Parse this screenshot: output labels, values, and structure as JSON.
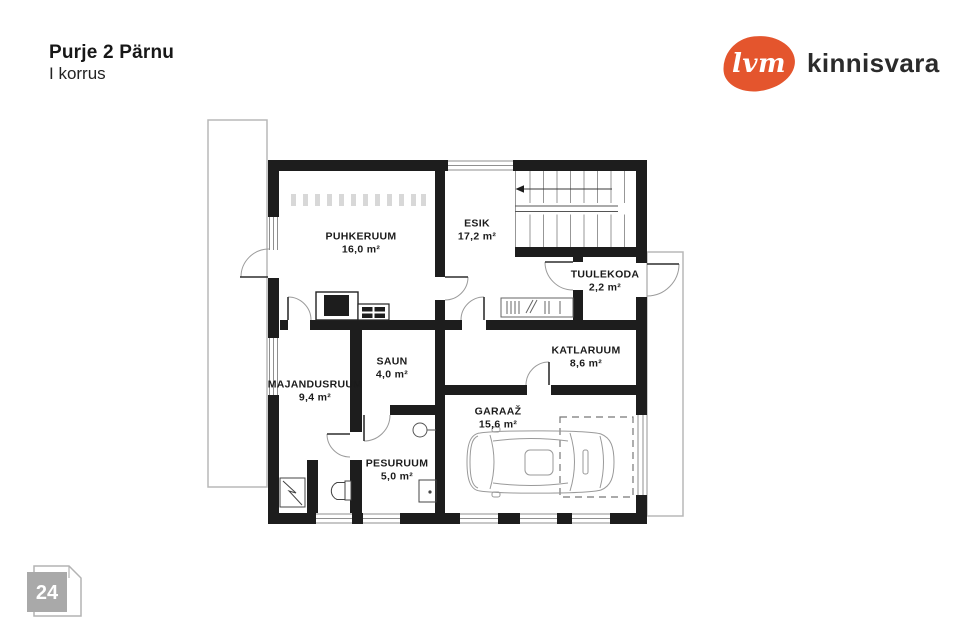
{
  "header": {
    "title": "Purje 2 Pärnu",
    "subtitle": "I korrus"
  },
  "logo": {
    "mark": "lvm",
    "brand": "kinnisvara",
    "accent_color": "#e4552d",
    "text_color": "#2b2b2b"
  },
  "page_badge": {
    "number": "24",
    "fill_color": "#a9a9a9"
  },
  "plan": {
    "wall_color": "#1d1d1d"
  },
  "rooms": [
    {
      "id": "puhkeruum",
      "name": "PUHKERUUM",
      "area": "16,0 m²"
    },
    {
      "id": "esik",
      "name": "ESIK",
      "area": "17,2 m²"
    },
    {
      "id": "tuulekoda",
      "name": "TUULEKODA",
      "area": "2,2 m²"
    },
    {
      "id": "katlaruum",
      "name": "KATLARUUM",
      "area": "8,6 m²"
    },
    {
      "id": "garaaz",
      "name": "GARAAŽ",
      "area": "15,6 m²"
    },
    {
      "id": "saun",
      "name": "SAUN",
      "area": "4,0 m²"
    },
    {
      "id": "majandusruum",
      "name": "MAJANDUSRUUM",
      "area": "9,4 m²"
    },
    {
      "id": "pesuruum",
      "name": "PESURUUM",
      "area": "5,0 m²"
    }
  ]
}
